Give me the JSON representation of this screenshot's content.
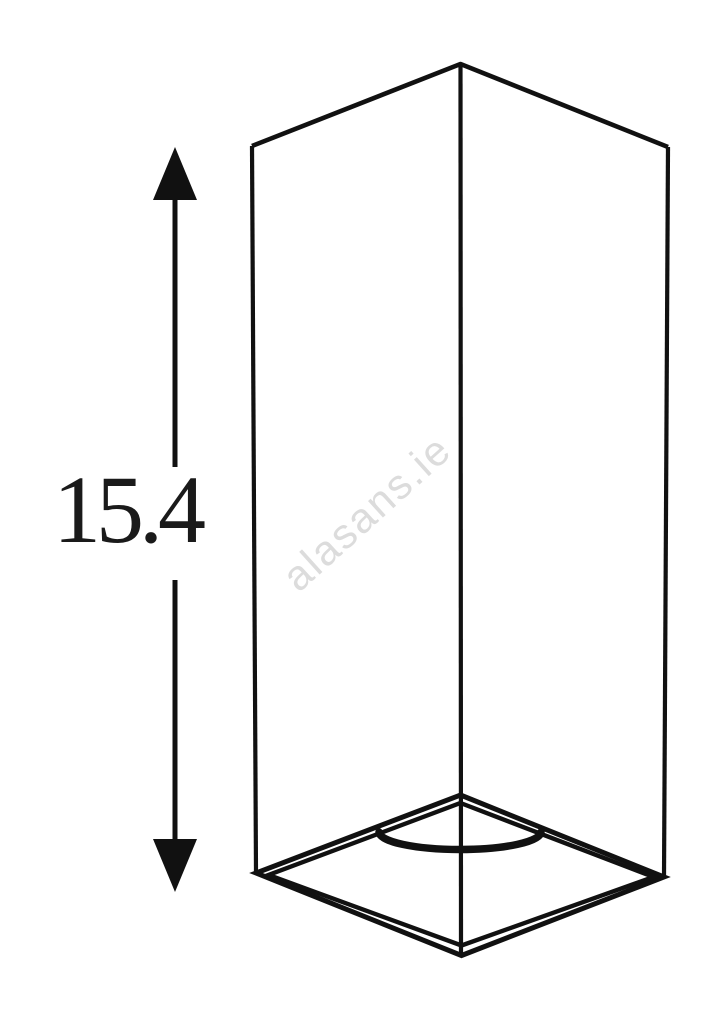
{
  "figure": {
    "dimension": {
      "value": "15.4"
    },
    "watermark": {
      "text": "alasans.ie"
    }
  },
  "colors": {
    "background": "#ffffff",
    "line": "#111111",
    "dimension_text": "#1a1a1a",
    "watermark": "#dcdcdc"
  }
}
